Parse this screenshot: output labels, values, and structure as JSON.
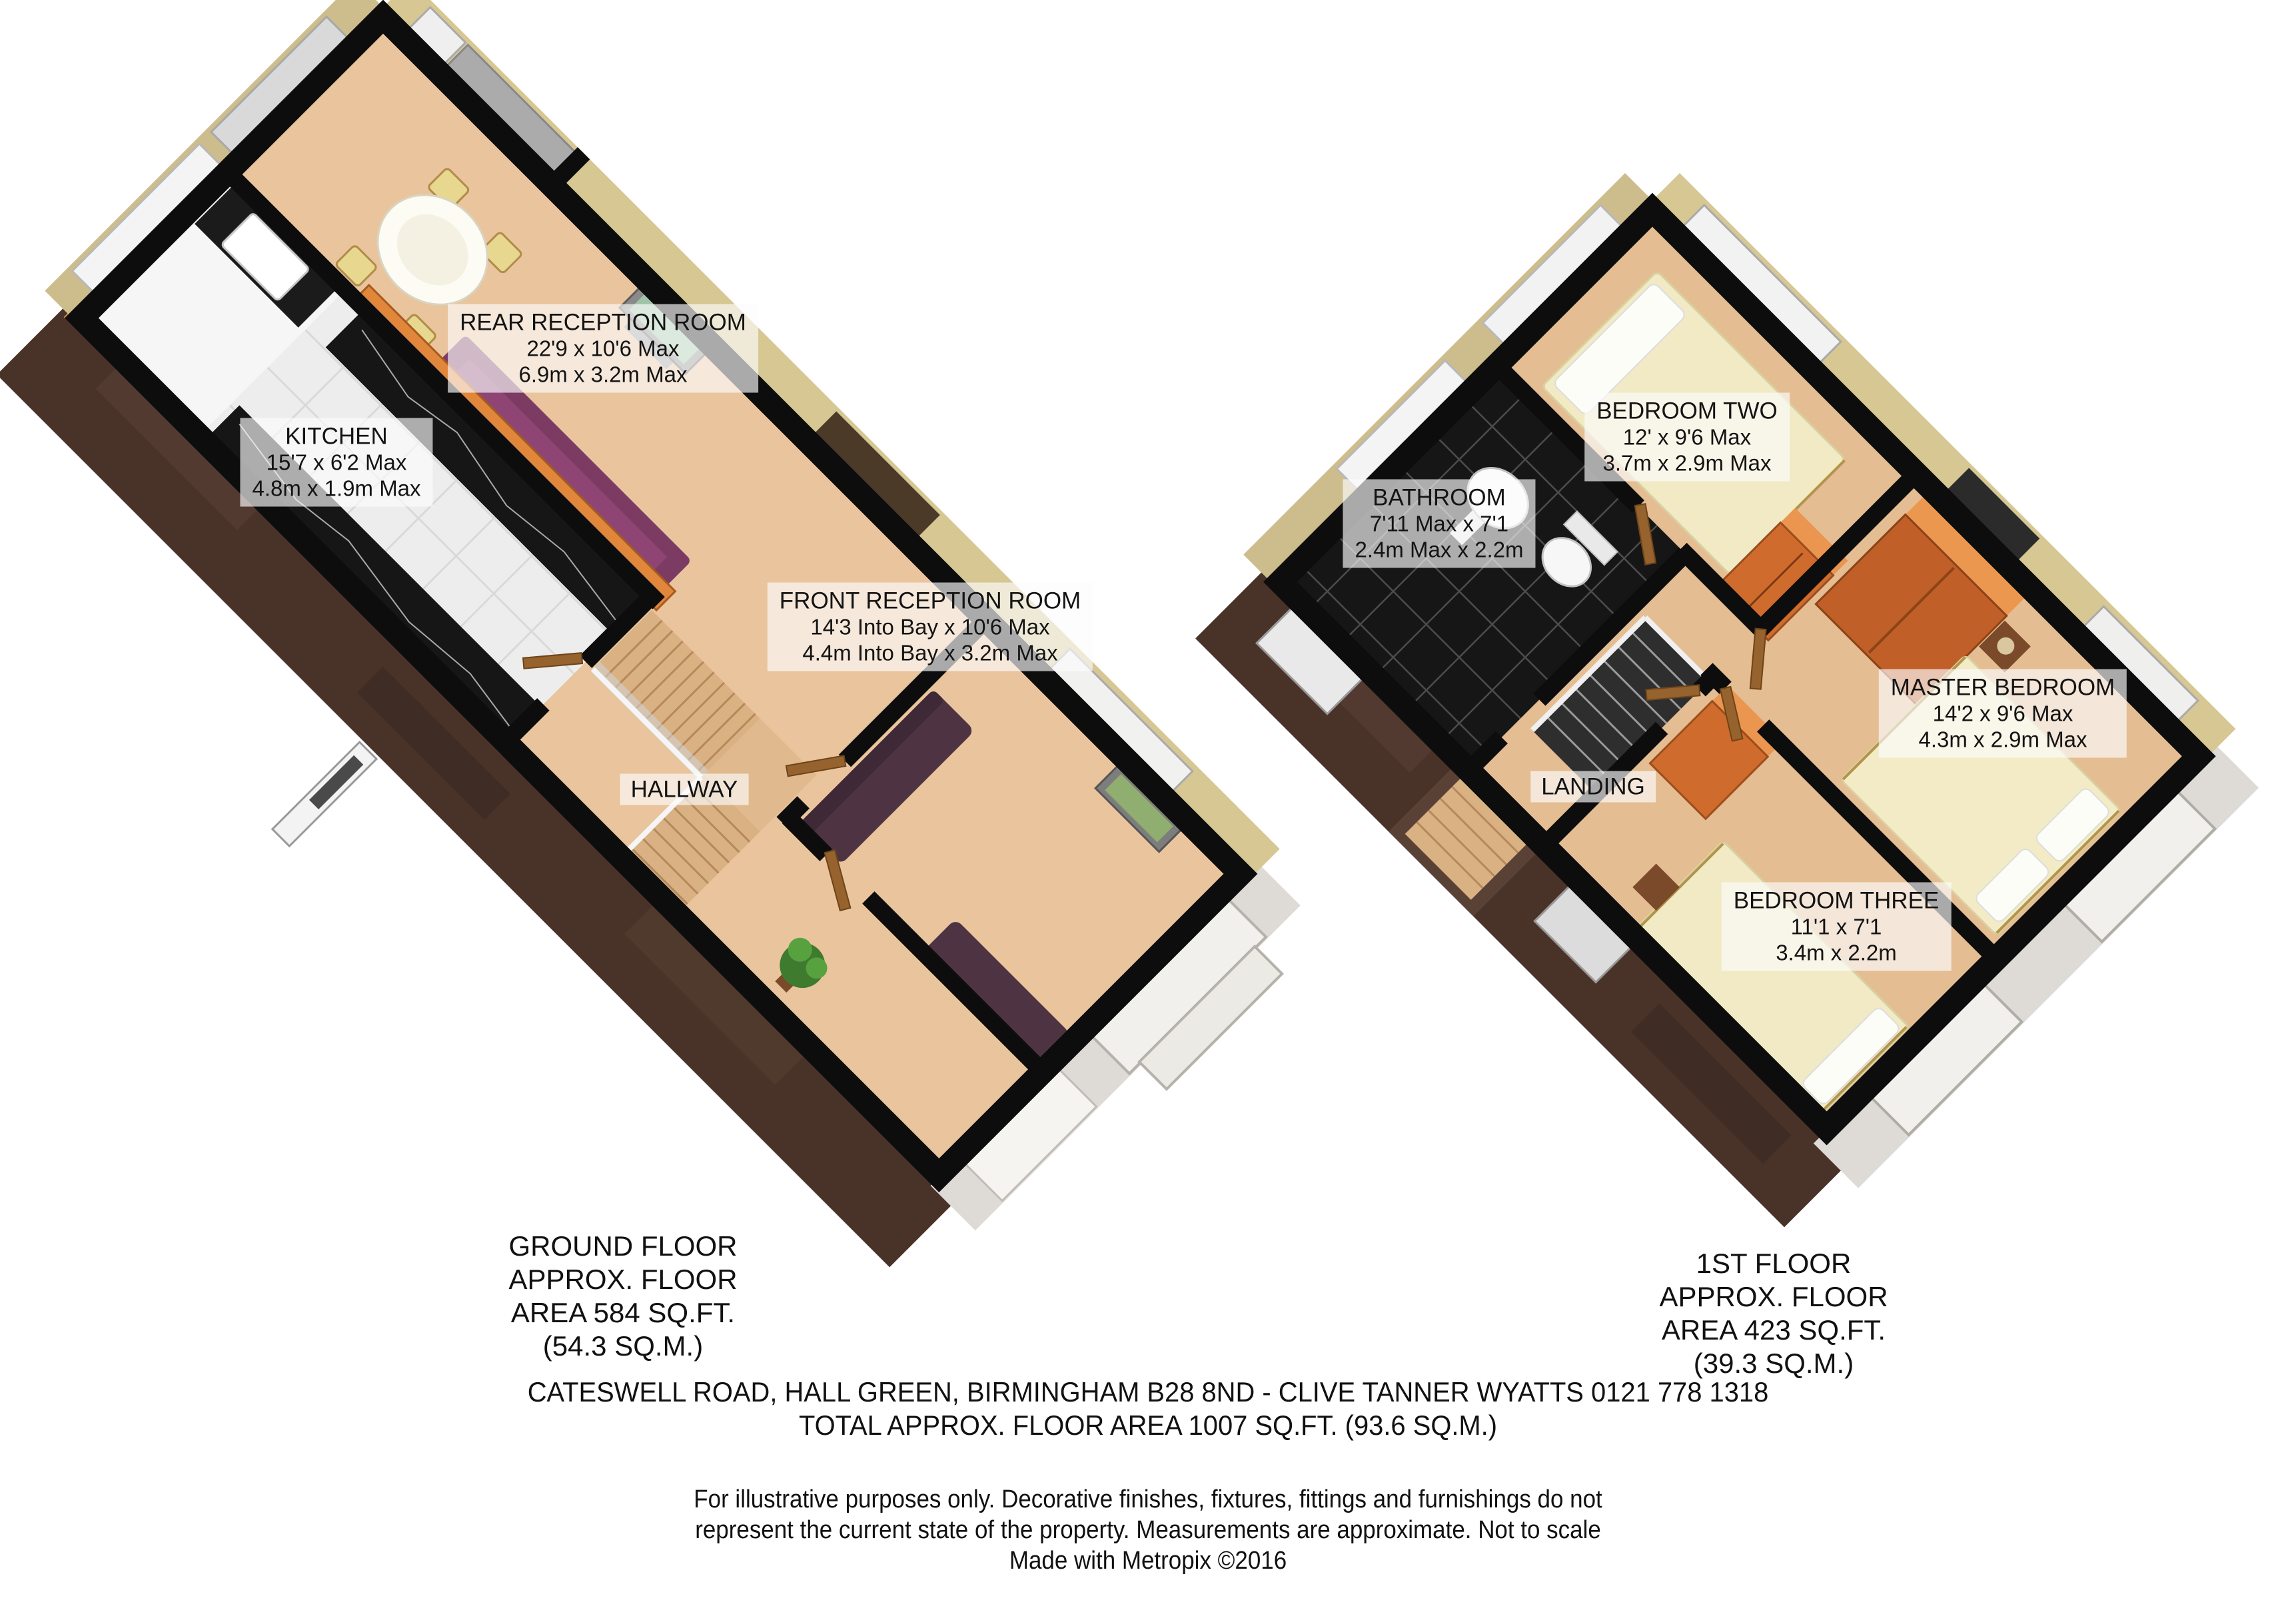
{
  "page": {
    "background": "#ffffff"
  },
  "ground_floor": {
    "rooms": {
      "rear_reception": {
        "name": "REAR RECEPTION ROOM",
        "imperial": "22'9 x 10'6 Max",
        "metric": "6.9m x 3.2m Max"
      },
      "kitchen": {
        "name": "KITCHEN",
        "imperial": "15'7 x 6'2 Max",
        "metric": "4.8m x 1.9m Max"
      },
      "front_reception": {
        "name": "FRONT RECEPTION ROOM",
        "imperial": "14'3 Into Bay x 10'6 Max",
        "metric": "4.4m Into Bay x 3.2m Max"
      },
      "hallway": {
        "name": "HALLWAY"
      }
    },
    "title_lines": [
      "GROUND FLOOR",
      "APPROX. FLOOR",
      "AREA 584 SQ.FT.",
      "(54.3 SQ.M.)"
    ]
  },
  "first_floor": {
    "rooms": {
      "bedroom_two": {
        "name": "BEDROOM TWO",
        "imperial": "12' x 9'6 Max",
        "metric": "3.7m x 2.9m Max"
      },
      "bathroom": {
        "name": "BATHROOM",
        "imperial": "7'11 Max x 7'1",
        "metric": "2.4m Max x 2.2m"
      },
      "master_bedroom": {
        "name": "MASTER BEDROOM",
        "imperial": "14'2 x 9'6 Max",
        "metric": "4.3m x 2.9m Max"
      },
      "landing": {
        "name": "LANDING"
      },
      "bedroom_three": {
        "name": "BEDROOM THREE",
        "imperial": "11'1 x 7'1",
        "metric": "3.4m x 2.2m"
      }
    },
    "title_lines": [
      "1ST FLOOR",
      "APPROX. FLOOR",
      "AREA 423 SQ.FT.",
      "(39.3 SQ.M.)"
    ]
  },
  "footer": {
    "address_line": "CATESWELL ROAD, HALL GREEN, BIRMINGHAM B28 8ND - CLIVE TANNER WYATTS 0121 778 1318",
    "total_line": "TOTAL APPROX. FLOOR AREA 1007 SQ.FT. (93.6 SQ.M.)",
    "disclaimer_lines": [
      "For illustrative purposes only.  Decorative finishes, fixtures, fittings and furnishings do not",
      "represent the current state of the property.  Measurements are approximate.  Not to scale",
      "Made with Metropix ©2016"
    ]
  },
  "colors": {
    "wall": "#0d0d0d",
    "floor_tan": "#e9c49c",
    "brick": "#493228",
    "khaki_wall": "#d6c793",
    "sofa_plum": "#8e4573",
    "sofa_dark": "#4e3443",
    "wardrobe_orange": "#d4732f",
    "bed_cream": "#f1eac5",
    "counter_black": "#161616",
    "cabinet_orange": "#e0873c",
    "label_bg": "rgba(252,252,252,0.66)"
  }
}
